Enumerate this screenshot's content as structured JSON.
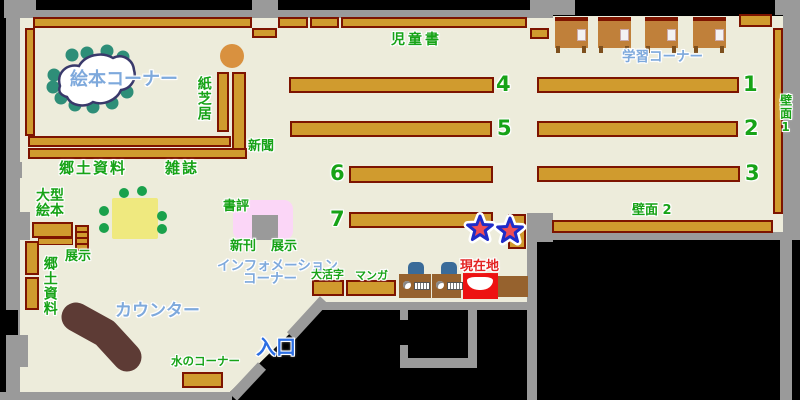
{
  "map_title": "library-floor-map",
  "legend_colors": {
    "floor": "#edecdb",
    "wall": "#9a9a9a",
    "outside": "#000000",
    "shelf_fill": "#d09b2e",
    "shelf_border": "#7d1400",
    "label_green": "#17a317",
    "label_light_blue": "#7ea9dc",
    "entrance_blue": "#2d6fe3",
    "current_location_red": "#e32222",
    "counter_brown": "#5d3b35",
    "table_yellow": "#efe97f",
    "star_red": "#ef4d55",
    "star_blue": "#1f2cc8"
  },
  "areas": {
    "picture_book_corner": "絵本コーナー",
    "kamishibai": "紙芝居",
    "newspaper": "新聞",
    "local_materials": "郷土資料",
    "magazines": "雑誌",
    "large_picture_books": [
      "大型",
      "絵本"
    ],
    "display_west": "展示",
    "local_materials_west": "郷土資料",
    "counter": "カウンター",
    "water_corner": "水のコーナー",
    "entrance": "入口",
    "children_books": "児童書",
    "study_corner": "学習コーナー",
    "wall_1": "壁面1",
    "wall_2": "壁面 2",
    "book_review": "書評",
    "new_arrivals": "新刊",
    "display_center": "展示",
    "information_corner": [
      "インフォメーション",
      "コーナー"
    ],
    "large_print": "大活字",
    "manga": "マンガ",
    "current_location": "現在地"
  },
  "shelf_numbers": {
    "s1": "1",
    "s2": "2",
    "s3": "3",
    "s4": "4",
    "s5": "5",
    "s6": "6",
    "s7": "7"
  }
}
